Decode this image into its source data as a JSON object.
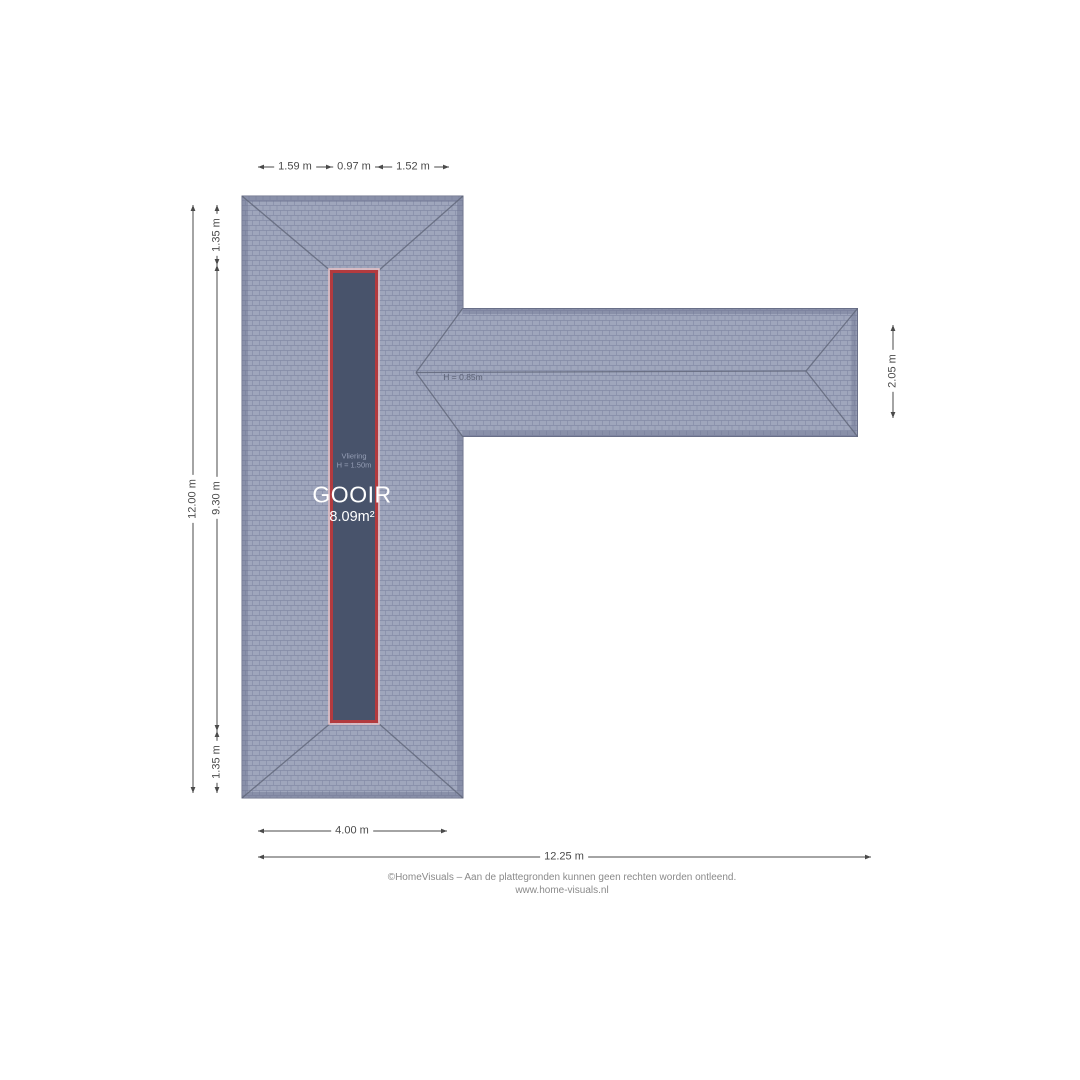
{
  "plan": {
    "room": {
      "loft_label": "Vliering",
      "loft_height": "H = 1.50m",
      "name": "GOOIR",
      "area": "8.09m²"
    },
    "annotations": {
      "wing_height": "H = 0.85m"
    },
    "dimensions": {
      "top": [
        "1.59 m",
        "0.97 m",
        "1.52 m"
      ],
      "left_outer": "12.00 m",
      "left_inner": [
        "1.35 m",
        "9.30 m",
        "1.35 m"
      ],
      "right": "2.05 m",
      "bottom_wing": "4.00 m",
      "bottom_total": "12.25 m"
    },
    "colors": {
      "roof_tile": "#9fa6bc",
      "roof_grid": "#868da8",
      "roof_edge_band": "#6f7692",
      "roof_line": "#5f6578",
      "room_fill": "#48536b",
      "room_border": "#b23a3e",
      "dimension_line": "#4a4a4a"
    }
  },
  "footer": {
    "line1": "©HomeVisuals – Aan de plattegronden kunnen geen rechten worden ontleend.",
    "line2": "www.home-visuals.nl"
  }
}
